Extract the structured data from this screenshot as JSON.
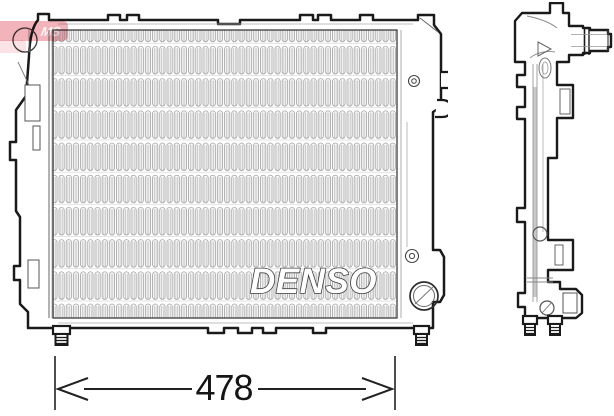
{
  "brand_logo": {
    "text": "DENSO",
    "fill": "#ffffff",
    "outline": "#3f3f3f"
  },
  "dimension": {
    "value": "478"
  },
  "watermark": {
    "text": "MS",
    "color": "#e0495e"
  },
  "figures": {
    "front": "radiator-front-view",
    "side": "radiator-side-profile-view"
  },
  "colors": {
    "outline": "#1a1a1a",
    "detail_line": "#5a5a5a",
    "fin_line": "#9c9c9c",
    "background": "#ffffff"
  }
}
